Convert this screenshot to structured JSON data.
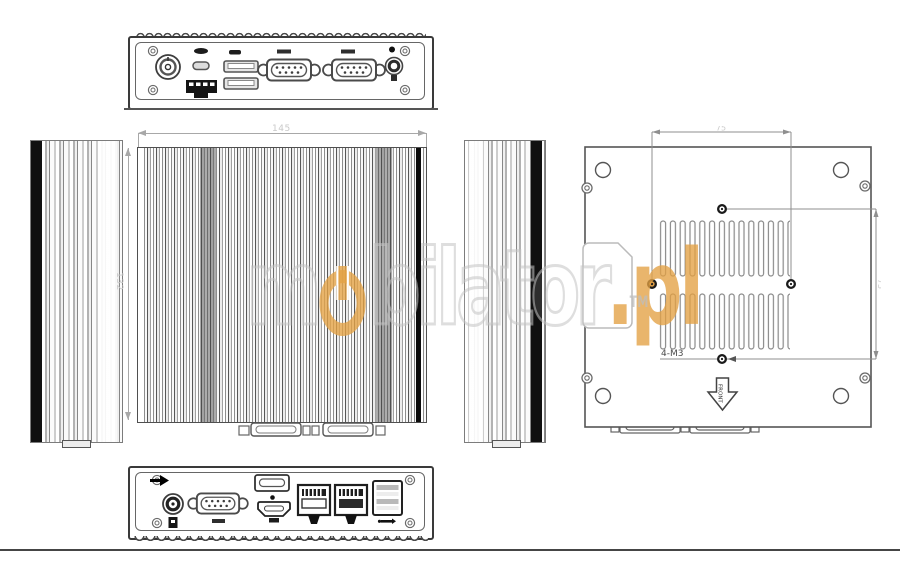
{
  "watermark": {
    "pre": "m",
    "post": "bilator",
    "tld": ".pl",
    "tm": "TM",
    "orange": "#e3a043"
  },
  "center_view": {
    "width_dim": "145",
    "height_dim": "132"
  },
  "plate_view": {
    "top_dim": "75",
    "side_dim": "75",
    "holes_label": "4-M3",
    "front_label": "FRONT"
  }
}
